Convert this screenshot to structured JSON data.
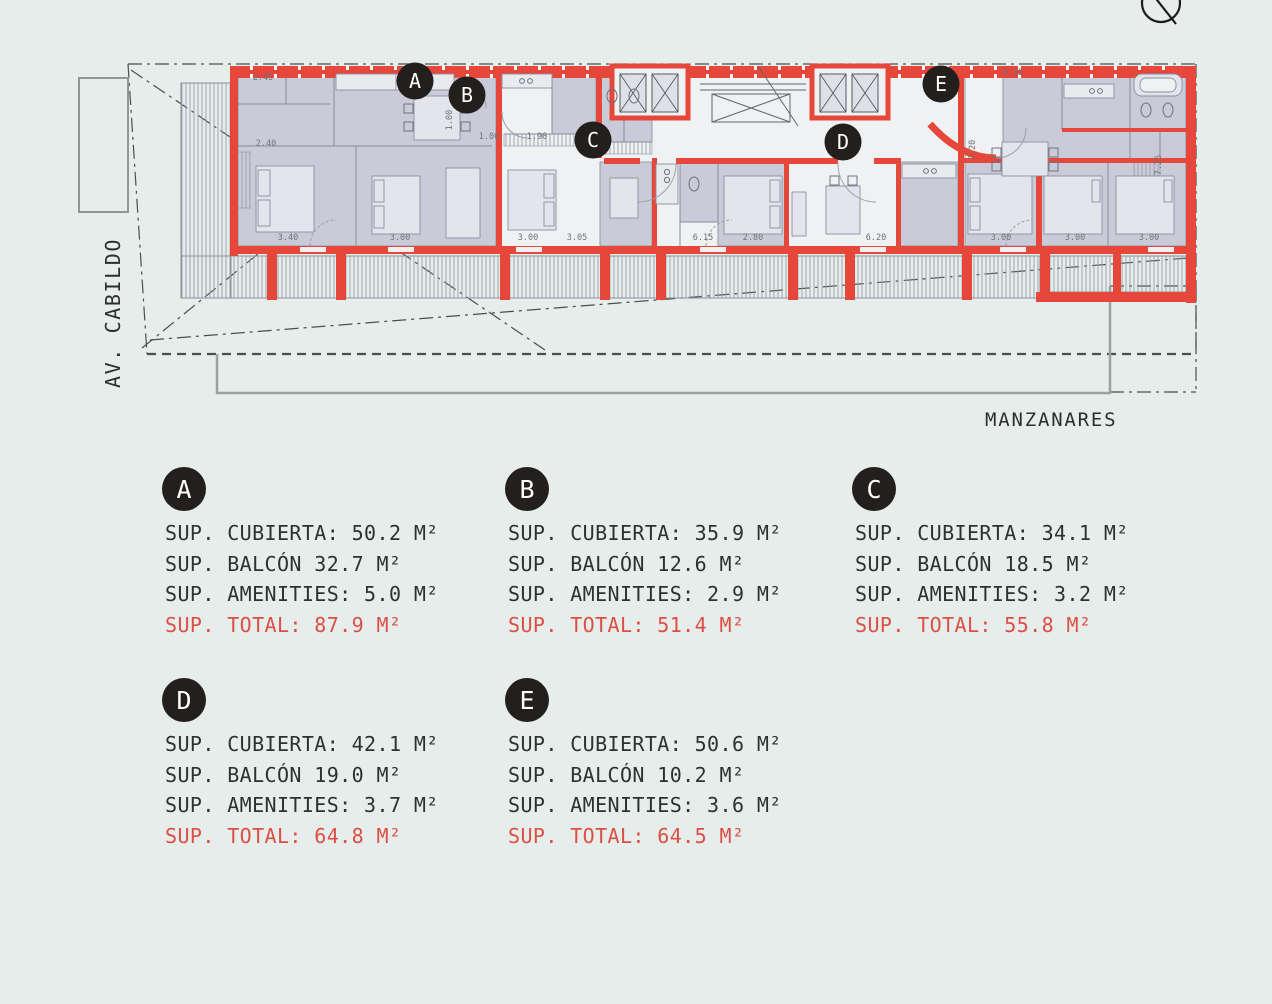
{
  "colors": {
    "background": "#e6edeb",
    "wall_red": "#e5473b",
    "room_gray": "#c9ccd8",
    "room_white": "#eff1f3",
    "line_gray": "#8a8fa0",
    "site_line": "#4a4f4e",
    "badge_black": "#221f1c",
    "legend_text": "#2c3231",
    "legend_total_red": "#dd4f44"
  },
  "north_symbol": "north-arrow",
  "plan": {
    "street_left": "AV. CABILDO",
    "street_bottom": "MANZANARES",
    "markers": [
      {
        "id": "A",
        "x": 415,
        "y": 81
      },
      {
        "id": "B",
        "x": 467,
        "y": 95
      },
      {
        "id": "C",
        "x": 593,
        "y": 140
      },
      {
        "id": "D",
        "x": 843,
        "y": 142
      },
      {
        "id": "E",
        "x": 941,
        "y": 84
      }
    ],
    "dimensions": [
      {
        "t": "2.45",
        "x": 263,
        "y": 80
      },
      {
        "t": "2.40",
        "x": 266,
        "y": 146
      },
      {
        "t": "1.00",
        "x": 452,
        "y": 120,
        "r": -90
      },
      {
        "t": "3.40",
        "x": 288,
        "y": 240
      },
      {
        "t": "3.00",
        "x": 400,
        "y": 240
      },
      {
        "t": "1.00",
        "x": 489,
        "y": 139
      },
      {
        "t": "1.90",
        "x": 537,
        "y": 139
      },
      {
        "t": "3.00",
        "x": 528,
        "y": 240
      },
      {
        "t": "3.05",
        "x": 577,
        "y": 240
      },
      {
        "t": "6.15",
        "x": 703,
        "y": 240
      },
      {
        "t": "2.80",
        "x": 753,
        "y": 240
      },
      {
        "t": "6.20",
        "x": 876,
        "y": 240
      },
      {
        "t": "3.00",
        "x": 1001,
        "y": 240
      },
      {
        "t": "6.15",
        "x": 1013,
        "y": 75
      },
      {
        "t": "7.20",
        "x": 975,
        "y": 150,
        "r": -90
      },
      {
        "t": "3.00",
        "x": 1075,
        "y": 240
      },
      {
        "t": "3.00",
        "x": 1149,
        "y": 240
      },
      {
        "t": "7.25",
        "x": 1161,
        "y": 165,
        "r": -90
      }
    ]
  },
  "legend": {
    "units": [
      {
        "id": "A",
        "lines": [
          "SUP. CUBIERTA: 50.2 M²",
          "SUP. BALCÓN 32.7 M²",
          "SUP. AMENITIES: 5.0 M²"
        ],
        "total": "SUP. TOTAL: 87.9 M²"
      },
      {
        "id": "B",
        "lines": [
          "SUP. CUBIERTA: 35.9 M²",
          "SUP. BALCÓN 12.6 M²",
          "SUP. AMENITIES: 2.9 M²"
        ],
        "total": "SUP. TOTAL: 51.4 M²"
      },
      {
        "id": "C",
        "lines": [
          "SUP. CUBIERTA: 34.1 M²",
          "SUP. BALCÓN 18.5 M²",
          "SUP. AMENITIES: 3.2 M²"
        ],
        "total": "SUP. TOTAL: 55.8 M²"
      },
      {
        "id": "D",
        "lines": [
          "SUP. CUBIERTA: 42.1 M²",
          "SUP. BALCÓN 19.0 M²",
          "SUP. AMENITIES: 3.7 M²"
        ],
        "total": "SUP. TOTAL: 64.8 M²"
      },
      {
        "id": "E",
        "lines": [
          "SUP. CUBIERTA: 50.6 M²",
          "SUP. BALCÓN 10.2 M²",
          "SUP. AMENITIES: 3.6 M²"
        ],
        "total": "SUP. TOTAL: 64.5 M²"
      }
    ]
  }
}
